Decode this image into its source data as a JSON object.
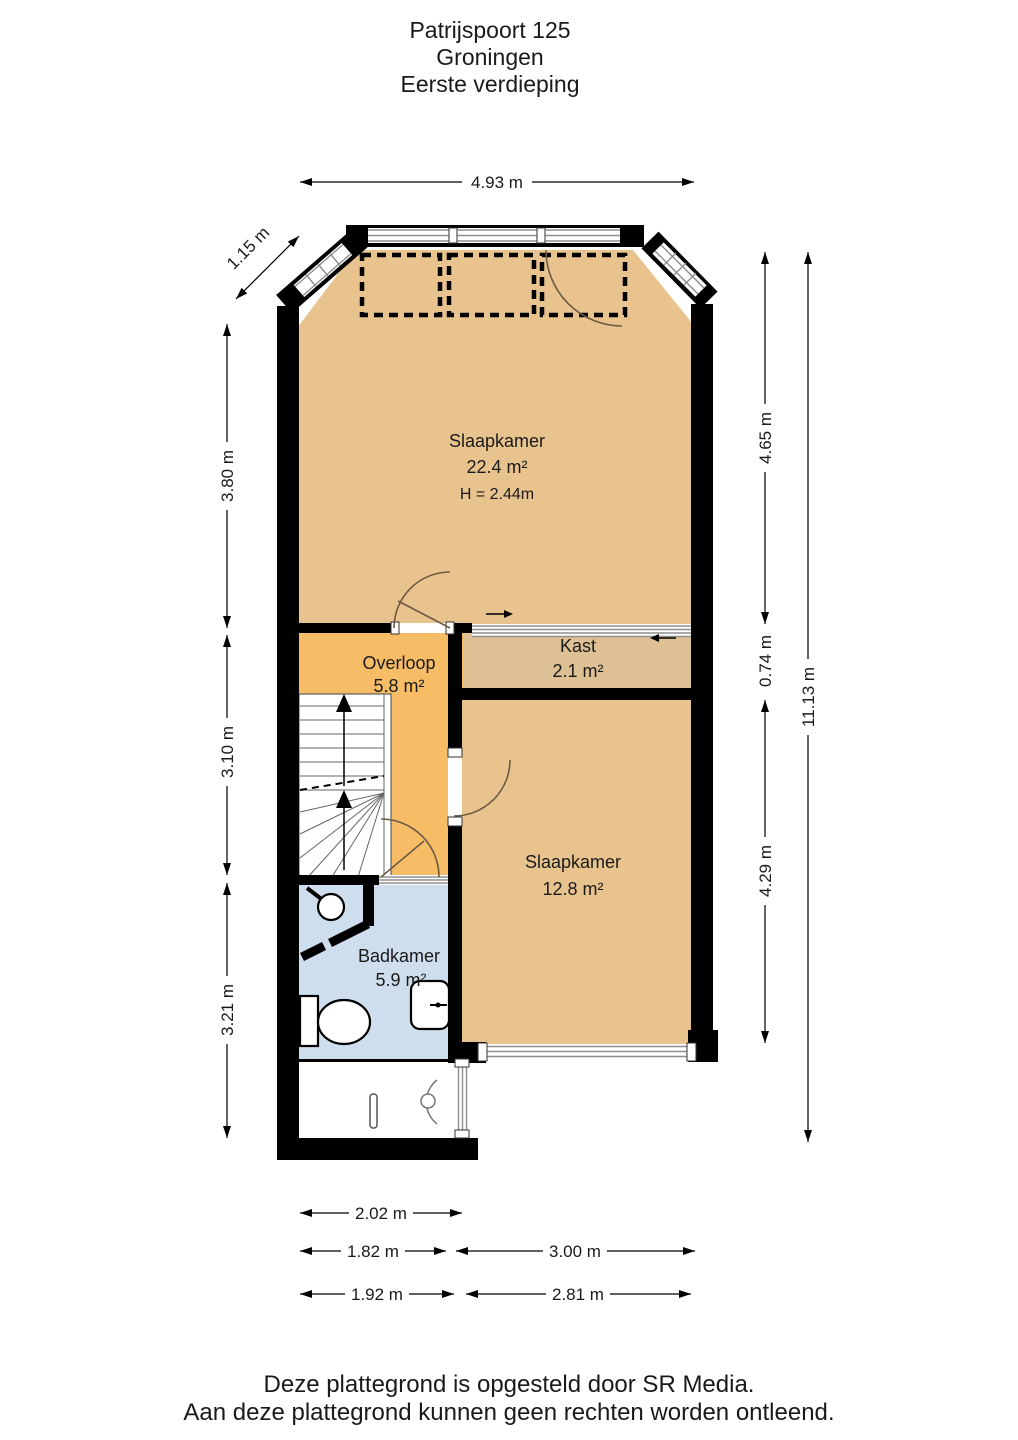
{
  "title": {
    "line1": "Patrijspoort 125",
    "line2": "Groningen",
    "line3": "Eerste verdieping"
  },
  "rooms": {
    "slaapkamer1": {
      "name": "Slaapkamer",
      "area": "22.4 m²",
      "ceiling_height": "H = 2.44m"
    },
    "kast": {
      "name": "Kast",
      "area": "2.1 m²"
    },
    "overloop": {
      "name": "Overloop",
      "area": "5.8 m²"
    },
    "slaapkamer2": {
      "name": "Slaapkamer",
      "area": "12.8 m²"
    },
    "badkamer": {
      "name": "Badkamer",
      "area": "5.9 m²"
    }
  },
  "dimensions": {
    "top_width": "4.93 m",
    "diagonal": "1.15 m",
    "left": [
      "3.80 m",
      "3.10 m",
      "3.21 m"
    ],
    "right_inner": [
      "4.65 m",
      "0.74 m",
      "4.29 m"
    ],
    "right_total": "11.13 m",
    "bottom_row1": [
      "2.02 m"
    ],
    "bottom_row2": [
      "1.82 m",
      "3.00 m"
    ],
    "bottom_row3": [
      "1.92 m",
      "2.81 m"
    ]
  },
  "footer": {
    "line1": "Deze plattegrond is opgesteld door SR Media.",
    "line2": "Aan deze plattegrond kunnen geen rechten worden ontleend."
  },
  "colors": {
    "bedroom": "#e9c38d",
    "closet": "#ddc093",
    "landing": "#f7bc66",
    "bathroom": "#cfdeed",
    "wall": "#000000"
  }
}
